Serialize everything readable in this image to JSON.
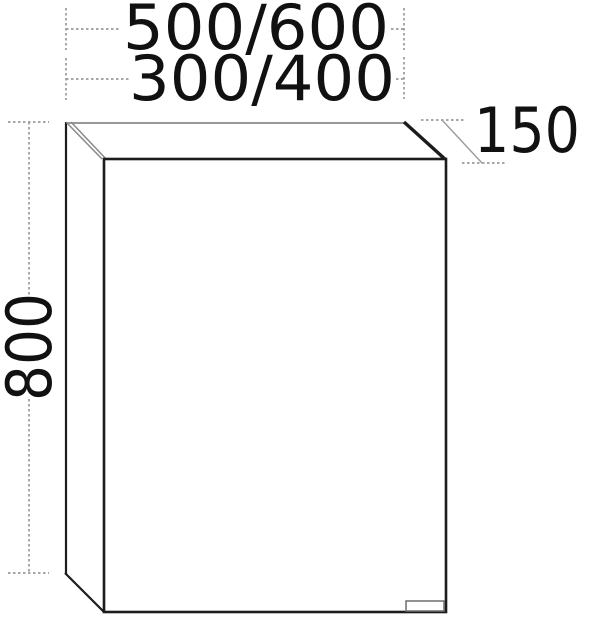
{
  "drawing": {
    "title": "wall-cabinet-dimension-drawing",
    "labels": {
      "width_row1": "500/600",
      "width_row2": "300/400",
      "height": "800",
      "depth": "150"
    },
    "colors": {
      "background": "#ffffff",
      "edge_dark": "#1c1c1c",
      "edge_light": "#8a8a8a",
      "dimension_line": "#9b9b9b",
      "text": "#111111"
    }
  }
}
